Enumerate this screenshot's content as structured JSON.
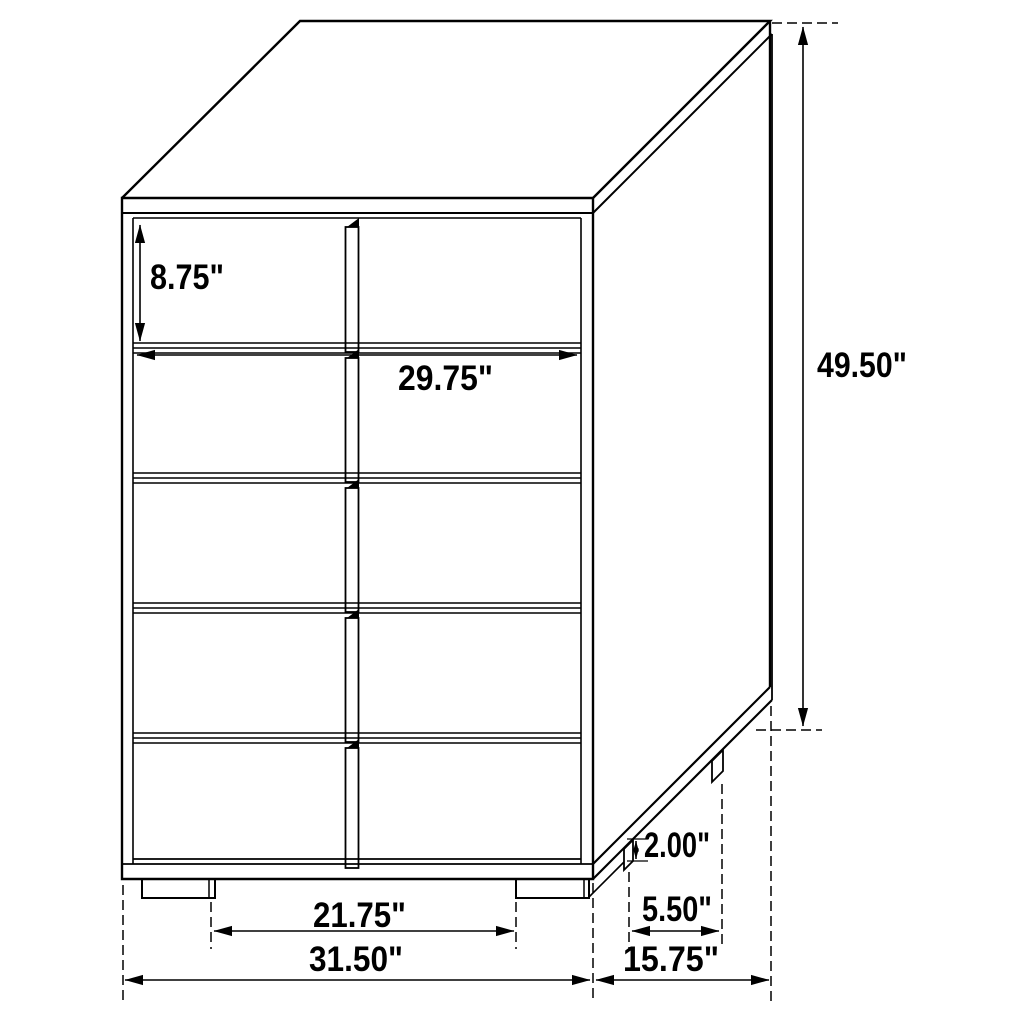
{
  "colors": {
    "line": "#000000",
    "background": "#ffffff",
    "text": "#000000"
  },
  "diagram": {
    "type": "furniture-dimension-drawing",
    "subject": "5-drawer chest",
    "drawer_count": 5,
    "unit": "inches",
    "labels": {
      "top_drawer_height": "8.75\"",
      "interior_width": "29.75\"",
      "overall_height": "49.50\"",
      "foot_height": "2.00\"",
      "side_foot_spacing": "5.50\"",
      "front_foot_spacing": "21.75\"",
      "overall_width": "31.50\"",
      "overall_depth": "15.75\""
    }
  }
}
